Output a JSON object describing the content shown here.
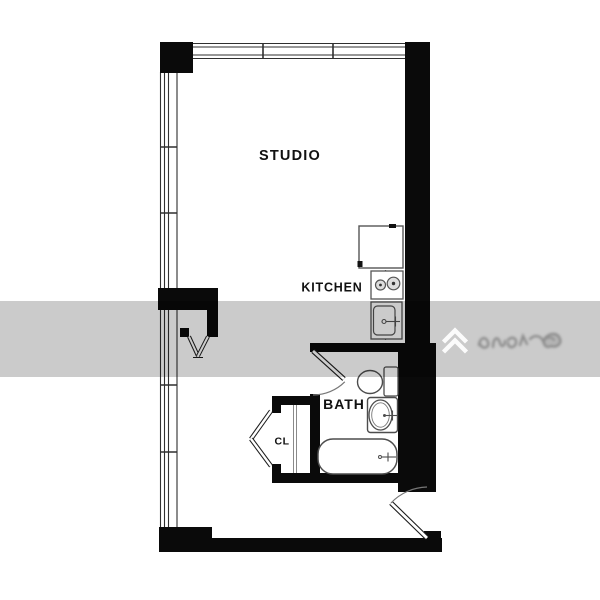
{
  "rooms": {
    "studio": "STUDIO",
    "kitchen": "KITCHEN",
    "bath": "BATH",
    "closet": "CL"
  },
  "fixtures": {
    "kitchen": [
      "refrigerator-icon",
      "stove-burners-icon",
      "kitchen-sink-icon"
    ],
    "bath": [
      "toilet-icon",
      "bathroom-sink-icon",
      "bathtub-icon"
    ],
    "doors": [
      "entry-door-swing-icon",
      "bath-door-swing-icon",
      "closet-bifold-door-icon",
      "unit-double-door-icon"
    ],
    "windows": [
      "window-band-top",
      "window-band-left"
    ]
  },
  "watermark": {
    "logo_icon": "double-chevron-logo-icon",
    "band_color": "#c9c9c9",
    "logo_color": "#ffffff"
  },
  "colors": {
    "wall": "#0a0a0a",
    "fixture_line": "#4d4d4d",
    "window_line": "#2f2f2f",
    "background": "#ffffff"
  }
}
